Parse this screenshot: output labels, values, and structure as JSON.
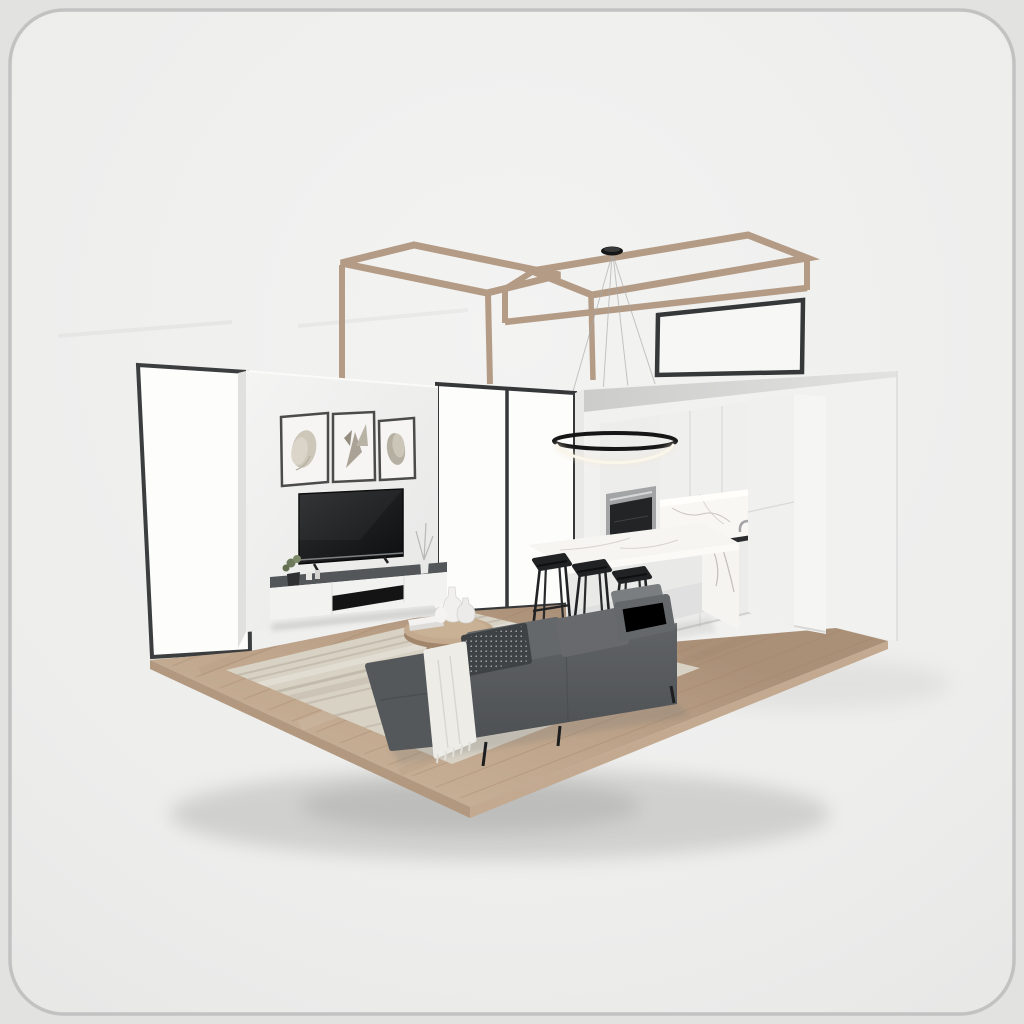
{
  "image": {
    "type": "3d-interior-render",
    "projection": "isometric-cutaway-diorama",
    "description": "Floating open-plan living room and kitchen on a wooden floor slab with white walls, black framed glass panels, suspended wood beam frames, ring pendant light, gray sofa, media wall and marble kitchen island."
  },
  "counts": {
    "gallery_frames": 3,
    "bar_stools": 3,
    "sofa_back_cushions": 3,
    "glass_panels_center": 2,
    "table_vases": 2
  },
  "objects": [
    "rounded-canvas-card",
    "soft-ground-shadow",
    "wood-beam-ceiling-frames",
    "pendant-ring-light",
    "clerestory-window",
    "glass-panel-left",
    "glass-panel-wall",
    "tv-feature-wall",
    "gallery-wall-art",
    "wall-mounted-tv",
    "floating-media-console",
    "potted-plant",
    "decor-branch",
    "area-rug",
    "round-coffee-table",
    "ceramic-vases",
    "stacked-books",
    "bird-figurine",
    "sofa-with-chaise",
    "scatter-cushions",
    "throw-blanket",
    "bar-stools",
    "kitchen-island",
    "kitchen-cabinets",
    "built-in-oven",
    "cooktop",
    "marble-backsplash",
    "kitchen-faucet",
    "wood-floor-platform"
  ],
  "palette": {
    "background": "#e2e2e1",
    "card_border": "#c2c2c2",
    "wall_white": "#f1f1f0",
    "wall_top_face": "#d2d2d1",
    "wall_side": "#e0e0df",
    "glass_white": "#fdfdfc",
    "frame_black": "#353738",
    "wood_beam": "#b49b85",
    "wood_floor": "#bda389",
    "wood_floor_side": "#b2987f",
    "plank_line": "#a18468",
    "rug": "#d8d2c5",
    "rug_streak": "#b3aa99",
    "sofa_body": "#5a5d60",
    "sofa_chaise": "#55585b",
    "sofa_cushion": "#65686b",
    "pillow_dark": "#3f4245",
    "pillow_light": "#7b7e81",
    "blanket": "#edece7",
    "table_wood": "#c3aa8e",
    "table_wood_dark": "#a1866c",
    "tv_screen": "#17181a",
    "console_top": "#54575a",
    "console_front": "#f2f2f1",
    "console_slot": "#141414",
    "stool_black": "#212224",
    "marble": "#f6f4f1",
    "marble_vein": "#bcb8b1",
    "island_base": "#e9e9e8",
    "cabinet_white": "#efefee",
    "cabinet_seam": "#d9d9d7",
    "oven_steel": "#a3a4a5",
    "oven_glass": "#232426",
    "cooktop": "#2b2c2e",
    "pendant_black": "#161617",
    "pendant_glow": "#f2e9d6",
    "wire": "#a9a9a9",
    "art_frame": "#4b4b4b",
    "art_beige": "#cdc7ba",
    "art_gray": "#a9a295",
    "plant_green": "#6e7a5c",
    "shadow": "#8e8e8c"
  }
}
